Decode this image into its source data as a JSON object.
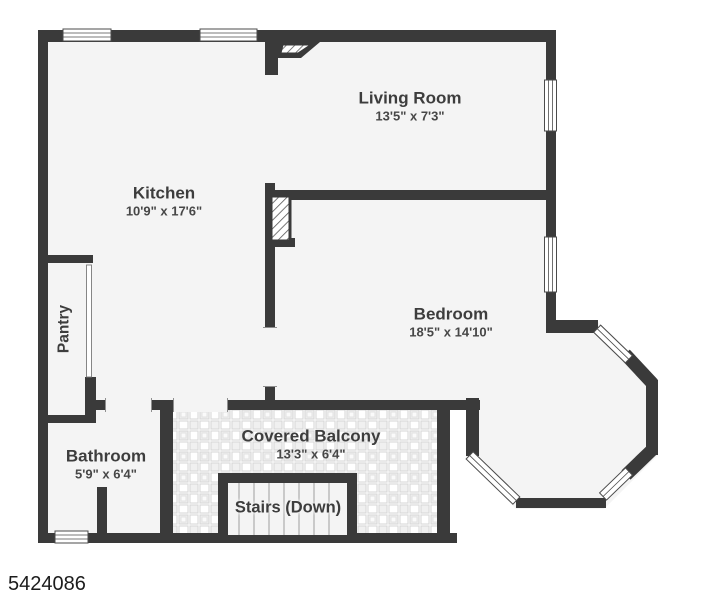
{
  "plan_id": "5424086",
  "rooms": {
    "living_room": {
      "name": "Living Room",
      "dims": "13'5\" x 7'3\""
    },
    "kitchen": {
      "name": "Kitchen",
      "dims": "10'9\" x 17'6\""
    },
    "bedroom": {
      "name": "Bedroom",
      "dims": "18'5\" x 14'10\""
    },
    "pantry": {
      "name": "Pantry"
    },
    "bathroom": {
      "name": "Bathroom",
      "dims": "5'9\" x 6'4\""
    },
    "covered_balcony": {
      "name": "Covered Balcony",
      "dims": "13'3\" x 6'4\""
    },
    "stairs": {
      "name": "Stairs (Down)"
    }
  },
  "colors": {
    "wall": "#3a3a3a",
    "floor": "#f4f4f4",
    "label": "#3d3d3d",
    "tile_line": "#d6d6d6"
  }
}
